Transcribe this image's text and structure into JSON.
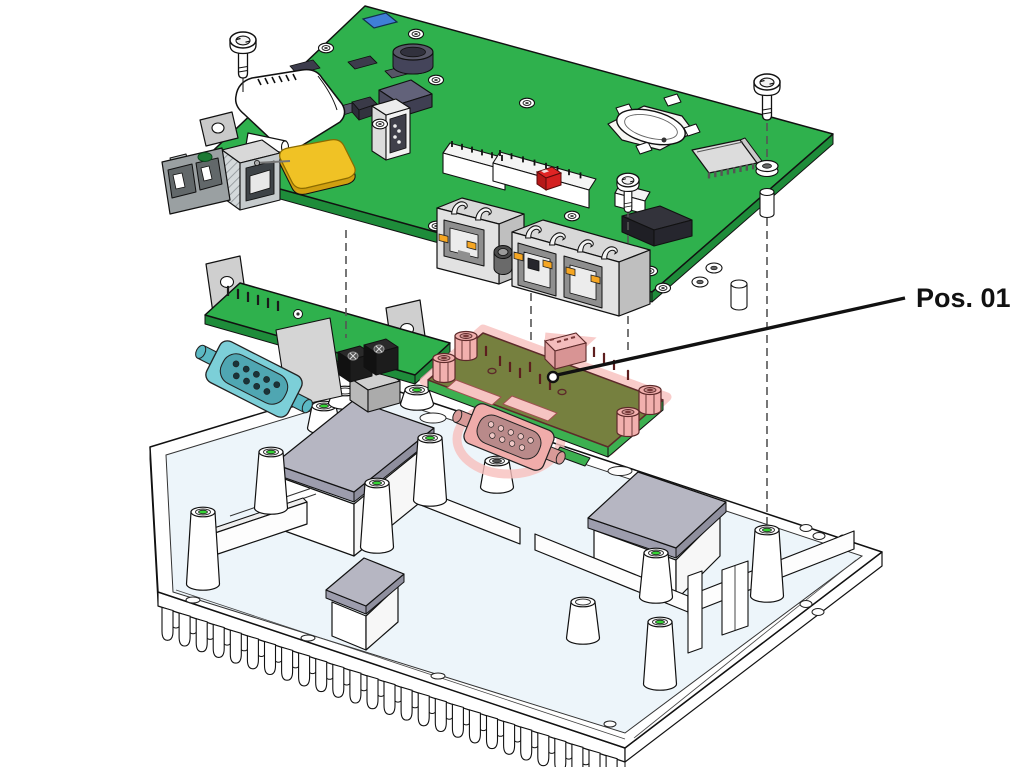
{
  "callout": {
    "label": "Pos. 01"
  },
  "colors": {
    "background": "#ffffff",
    "outline": "#111111",
    "pcb_green": "#2fb14d",
    "pcb_green_dark": "#1e8c3a",
    "pos01_board": "#76803f",
    "pos01_edge": "#3cb050",
    "highlight_pink": "#f2b0ae",
    "highlight_halo": "#f8c0be",
    "teal": "#7ccfd8",
    "teal_dark": "#4fa6b2",
    "chassis_fill": "#edf5fa",
    "pad_gray": "#b6b6c2",
    "pad_gray_dark": "#9d9dad",
    "metal_gray": "#cfcfcf",
    "chip_slate": "#62627a",
    "chip_dark": "#3c3c4c",
    "chip_black": "#2b2b33",
    "yellow": "#f0c225",
    "yellow_dark": "#cf9f10",
    "led_orange": "#f5a623",
    "red_comp": "#e02424",
    "blue_comp": "#3f7fd6",
    "hole_green": "#35d435",
    "screw_line": "#555555",
    "leader": "#111111"
  }
}
